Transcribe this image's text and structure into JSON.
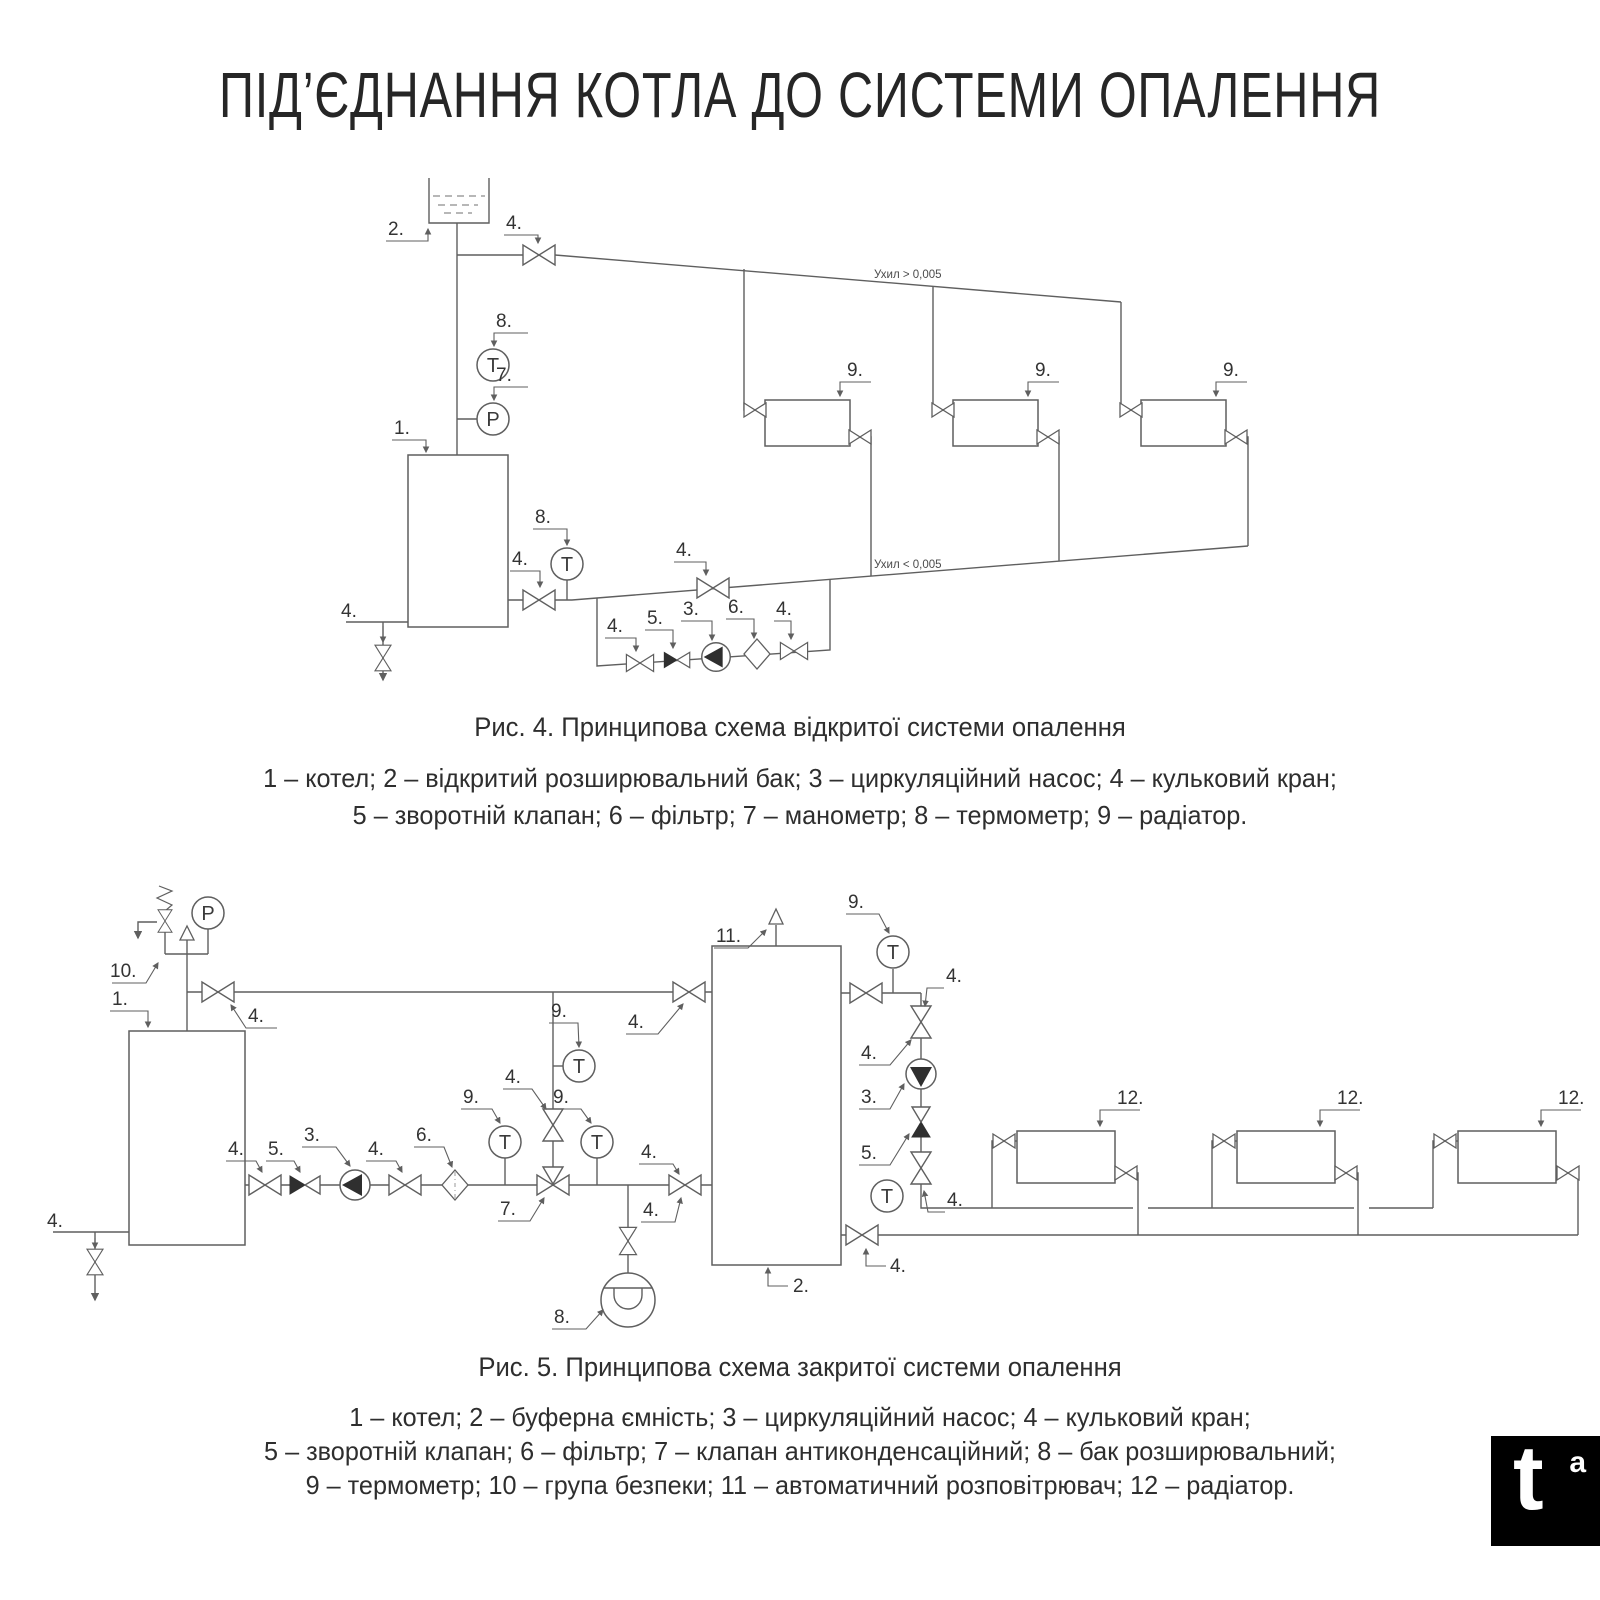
{
  "title": "ПІД’ЄДНАННЯ КОТЛА ДО СИСТЕМИ ОПАЛЕННЯ",
  "figure4": {
    "caption": "Рис. 4. Принципова схема відкритої системи опалення",
    "legend_lines": [
      "1 – котел; 2 – відкритий розширювальний бак; 3 – циркуляційний насос;  4 – кульковий кран;",
      "5 – зворотній клапан; 6 – фільтр; 7 – манометр; 8 – термометр; 9 – радіатор."
    ],
    "slope_supply": "Ухил > 0,005",
    "slope_return": "Ухил < 0,005"
  },
  "figure5": {
    "caption": "Рис. 5. Принципова схема закритої системи опалення",
    "legend_lines": [
      "1 – котел; 2 – буферна ємність; 3 – циркуляційний насос; 4 – кульковий кран;",
      "5 – зворотній клапан; 6 – фільтр; 7 – клапан антиконденсаційний; 8 – бак розширювальний;",
      "9 – термометр; 10 – група безпеки; 11 – автоматичний розповітрювач; 12 – радіатор."
    ]
  },
  "labels": {
    "l1": "1.",
    "l2": "2.",
    "l3": "3.",
    "l4": "4.",
    "l5": "5.",
    "l6": "6.",
    "l7": "7.",
    "l8": "8.",
    "l9": "9.",
    "l10": "10.",
    "l11": "11.",
    "l12": "12."
  },
  "instruments": {
    "thermometer": "T",
    "pressure": "P"
  },
  "colors": {
    "line": "#5f5f5f",
    "text": "#2e2e2e",
    "logo_bg": "#000000"
  },
  "logo": {
    "letter": "t",
    "sup": "a"
  }
}
